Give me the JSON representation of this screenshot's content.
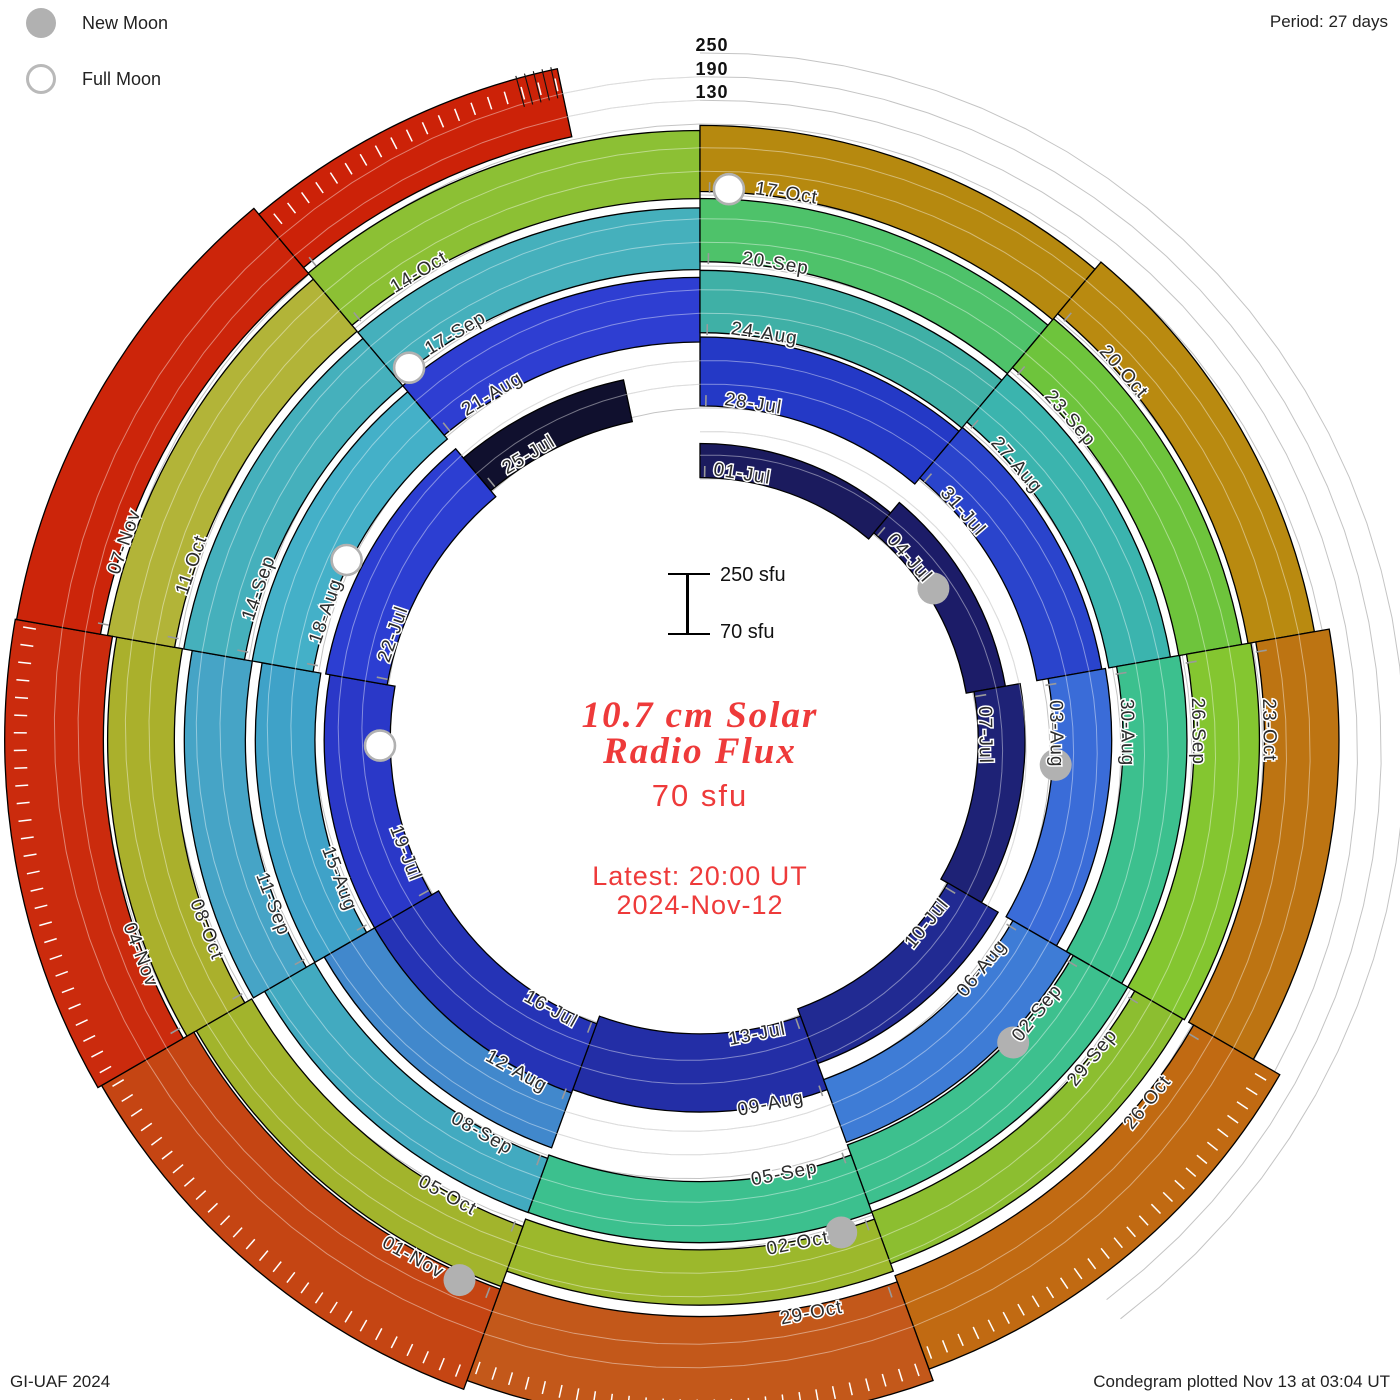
{
  "legend": {
    "new_moon_label": "New Moon",
    "full_moon_label": "Full Moon"
  },
  "header": {
    "period_note": "Period: 27 days"
  },
  "footer": {
    "credit": "GI-UAF 2024",
    "plotted_note": "Condegram plotted Nov 13 at 03:04 UT"
  },
  "radial_scale": {
    "labels": [
      "250",
      "190",
      "130"
    ]
  },
  "center": {
    "scale_top": "250 sfu",
    "scale_bottom": "70 sfu",
    "title_line1": "10.7 cm Solar",
    "title_line2": "Radio Flux",
    "current_value": "70 sfu",
    "latest_line1": "Latest: 20:00 UT",
    "latest_line2": "2024-Nov-12",
    "accent_color": "#ee3a3a"
  },
  "chart_data": {
    "type": "spiral_condegram",
    "title": "10.7 cm Solar Radio Flux",
    "period_days": 27,
    "date_start": "2024-Jul-01",
    "date_end": "2024-Nov-12",
    "flux_scale_sfu": {
      "min": 70,
      "max": 250,
      "ring_gridlines": [
        130,
        190,
        250
      ]
    },
    "grid_color": "#c4c4c4",
    "label_color": "#2b2b2b",
    "moon_color": "#b1b1b1",
    "segments": [
      {
        "date": "01-Jul",
        "ring": 0,
        "a0": 0,
        "a1": 40,
        "color": "#1b1b5e",
        "f0": 0.02,
        "f1": 0.5,
        "sfu": 120
      },
      {
        "date": "04-Jul",
        "ring": 0,
        "a0": 40,
        "a1": 80,
        "color": "#1c1c68",
        "f0": 0.02,
        "f1": 0.58,
        "sfu": 130
      },
      {
        "date": "07-Jul",
        "ring": 0,
        "a0": 80,
        "a1": 120,
        "color": "#1e2276",
        "f0": 0.02,
        "f1": 0.68,
        "sfu": 140
      },
      {
        "date": "10-Jul",
        "ring": 0,
        "a0": 120,
        "a1": 160,
        "color": "#212a92",
        "f0": 0.02,
        "f1": 0.84,
        "sfu": 155
      },
      {
        "date": "13-Jul",
        "ring": 0,
        "a0": 160,
        "a1": 200,
        "color": "#232ea6",
        "f0": 0.02,
        "f1": 1.12,
        "sfu": 215
      },
      {
        "date": "16-Jul",
        "ring": 0,
        "a0": 200,
        "a1": 240,
        "color": "#2533b6",
        "f0": 0.02,
        "f1": 1.06,
        "sfu": 205
      },
      {
        "date": "19-Jul",
        "ring": 0,
        "a0": 240,
        "a1": 280,
        "color": "#2a38c8",
        "f0": 0.02,
        "f1": 0.95,
        "sfu": 190
      },
      {
        "date": "22-Jul",
        "ring": 0,
        "a0": 280,
        "a1": 320,
        "color": "#2c3ed2",
        "f0": 0.02,
        "f1": 0.9,
        "sfu": 185
      },
      {
        "date": "25-Jul",
        "ring": 0,
        "a0": 320,
        "a1": 348,
        "color": "#10102e",
        "f0": 0.02,
        "f1": 0.62,
        "sfu": 135
      },
      {
        "date": "28-Jul",
        "ring": 1,
        "a0": 0,
        "a1": 40,
        "color": "#2439c6",
        "f0": 0.03,
        "f1": 1.0,
        "sfu": 190
      },
      {
        "date": "31-Jul",
        "ring": 1,
        "a0": 40,
        "a1": 80,
        "color": "#2a44cc",
        "f0": 0.03,
        "f1": 0.96,
        "sfu": 186
      },
      {
        "date": "03-Aug",
        "ring": 1,
        "a0": 80,
        "a1": 120,
        "color": "#3a6cd8",
        "f0": 0.08,
        "f1": 0.9,
        "sfu": 178
      },
      {
        "date": "06-Aug",
        "ring": 1,
        "a0": 120,
        "a1": 160,
        "color": "#3e7cd6",
        "f0": 0.08,
        "f1": 1.02,
        "sfu": 182
      },
      {
        "date": "09-Aug",
        "ring": 1,
        "a0": 160,
        "a1": 200,
        "color": null,
        "f0": 0,
        "f1": 0,
        "sfu": null
      },
      {
        "date": "12-Aug",
        "ring": 1,
        "a0": 200,
        "a1": 240,
        "color": "#4188cc",
        "f0": 0.06,
        "f1": 0.88,
        "sfu": 175
      },
      {
        "date": "15-Aug",
        "ring": 1,
        "a0": 240,
        "a1": 280,
        "color": "#3fa2c8",
        "f0": 0.08,
        "f1": 0.92,
        "sfu": 186
      },
      {
        "date": "18-Aug",
        "ring": 1,
        "a0": 280,
        "a1": 320,
        "color": "#44b0c8",
        "f0": 0.08,
        "f1": 0.95,
        "sfu": 195
      },
      {
        "date": "21-Aug",
        "ring": 1,
        "a0": 320,
        "a1": 360,
        "color": "#2e3ed2",
        "f0": 0.04,
        "f1": 0.95,
        "sfu": 185
      },
      {
        "date": "24-Aug",
        "ring": 2,
        "a0": 0,
        "a1": 40,
        "color": "#3fb0a6",
        "f0": 0.06,
        "f1": 0.94,
        "sfu": 196
      },
      {
        "date": "27-Aug",
        "ring": 2,
        "a0": 40,
        "a1": 80,
        "color": "#3bb4ae",
        "f0": 0.06,
        "f1": 0.94,
        "sfu": 196
      },
      {
        "date": "30-Aug",
        "ring": 2,
        "a0": 80,
        "a1": 120,
        "color": "#3cc08e",
        "f0": 0.06,
        "f1": 0.96,
        "sfu": 200
      },
      {
        "date": "02-Sep",
        "ring": 2,
        "a0": 120,
        "a1": 160,
        "color": "#3dc08e",
        "f0": 0.06,
        "f1": 0.95,
        "sfu": 200
      },
      {
        "date": "05-Sep",
        "ring": 2,
        "a0": 160,
        "a1": 200,
        "color": "#3cc08e",
        "f0": 0.1,
        "f1": 0.96,
        "sfu": 200
      },
      {
        "date": "08-Sep",
        "ring": 2,
        "a0": 200,
        "a1": 240,
        "color": "#42aac0",
        "f0": 0.04,
        "f1": 0.85,
        "sfu": 188
      },
      {
        "date": "11-Sep",
        "ring": 2,
        "a0": 240,
        "a1": 280,
        "color": "#46a4c6",
        "f0": 0.06,
        "f1": 0.92,
        "sfu": 192
      },
      {
        "date": "14-Sep",
        "ring": 2,
        "a0": 280,
        "a1": 320,
        "color": "#45b0bc",
        "f0": 0.06,
        "f1": 0.93,
        "sfu": 195
      },
      {
        "date": "17-Sep",
        "ring": 2,
        "a0": 320,
        "a1": 360,
        "color": "#45b0bc",
        "f0": 0.06,
        "f1": 0.93,
        "sfu": 195
      },
      {
        "date": "20-Sep",
        "ring": 3,
        "a0": 0,
        "a1": 40,
        "color": "#4ec26a",
        "f0": 0.06,
        "f1": 0.95,
        "sfu": 205
      },
      {
        "date": "23-Sep",
        "ring": 3,
        "a0": 40,
        "a1": 80,
        "color": "#6ec43c",
        "f0": 0.06,
        "f1": 0.96,
        "sfu": 208
      },
      {
        "date": "26-Sep",
        "ring": 3,
        "a0": 80,
        "a1": 120,
        "color": "#84c630",
        "f0": 0.06,
        "f1": 0.98,
        "sfu": 210
      },
      {
        "date": "29-Sep",
        "ring": 3,
        "a0": 120,
        "a1": 160,
        "color": "#8cbe30",
        "f0": 0.06,
        "f1": 0.84,
        "sfu": 195
      },
      {
        "date": "02-Oct",
        "ring": 3,
        "a0": 160,
        "a1": 200,
        "color": "#9cb82c",
        "f0": 0.06,
        "f1": 0.84,
        "sfu": 195
      },
      {
        "date": "05-Oct",
        "ring": 3,
        "a0": 200,
        "a1": 240,
        "color": "#a2b42c",
        "f0": 0.06,
        "f1": 0.96,
        "sfu": 208
      },
      {
        "date": "08-Oct",
        "ring": 3,
        "a0": 240,
        "a1": 280,
        "color": "#aab02c",
        "f0": 0.06,
        "f1": 1.0,
        "sfu": 215
      },
      {
        "date": "11-Oct",
        "ring": 3,
        "a0": 280,
        "a1": 320,
        "color": "#b2b438",
        "f0": 0.06,
        "f1": 1.02,
        "sfu": 218
      },
      {
        "date": "14-Oct",
        "ring": 3,
        "a0": 320,
        "a1": 360,
        "color": "#8cc034",
        "f0": 0.06,
        "f1": 1.02,
        "sfu": 218
      },
      {
        "date": "17-Oct",
        "ring": 4,
        "a0": 0,
        "a1": 40,
        "color": "#b6890f",
        "f0": 0.05,
        "f1": 0.98,
        "sfu": 232
      },
      {
        "date": "20-Oct",
        "ring": 4,
        "a0": 40,
        "a1": 80,
        "color": "#b98a10",
        "f0": 0.05,
        "f1": 1.0,
        "sfu": 235
      },
      {
        "date": "23-Oct",
        "ring": 4,
        "a0": 80,
        "a1": 120,
        "color": "#bd7412",
        "f0": 0.05,
        "f1": 1.1,
        "sfu": 248
      },
      {
        "date": "26-Oct",
        "ring": 4,
        "a0": 120,
        "a1": 160,
        "color": "#c16a12",
        "f0": 0.02,
        "f1": 1.42,
        "sfu": 300,
        "ticks": "white"
      },
      {
        "date": "29-Oct",
        "ring": 4,
        "a0": 160,
        "a1": 200,
        "color": "#c3581a",
        "f0": 0.0,
        "f1": 1.48,
        "sfu": 305,
        "ticks": "white"
      },
      {
        "date": "01-Nov",
        "ring": 4,
        "a0": 200,
        "a1": 240,
        "color": "#c54513",
        "f0": 0.0,
        "f1": 1.5,
        "sfu": 310,
        "ticks": "white"
      },
      {
        "date": "04-Nov",
        "ring": 4,
        "a0": 240,
        "a1": 280,
        "color": "#cb2b0d",
        "f0": 0.06,
        "f1": 1.45,
        "sfu": 300,
        "ticks": "white"
      },
      {
        "date": "07-Nov",
        "ring": 4,
        "a0": 280,
        "a1": 320,
        "color": "#cc250a",
        "f0": 0.12,
        "f1": 1.32,
        "sfu": 290
      },
      {
        "date": "10-Nov",
        "ring": 4,
        "a0": 320,
        "a1": 348,
        "color": "#cc2208",
        "f0": 0.12,
        "f1": 1.1,
        "sfu": 272,
        "ticks": "white",
        "end_ticks": true,
        "label": false
      }
    ],
    "moons": {
      "new": [
        {
          "date": "2024-Jul-05",
          "ring": 0,
          "angle": 57
        },
        {
          "date": "2024-Aug-04",
          "ring": 1,
          "angle": 94
        },
        {
          "date": "2024-Sep-03",
          "ring": 2,
          "angle": 134
        },
        {
          "date": "2024-Oct-02",
          "ring": 3,
          "angle": 164
        },
        {
          "date": "2024-Nov-01",
          "ring": 4,
          "angle": 204
        }
      ],
      "full": [
        {
          "date": "2024-Jul-21",
          "ring": 0,
          "angle": 269
        },
        {
          "date": "2024-Aug-19",
          "ring": 1,
          "angle": 297
        },
        {
          "date": "2024-Sep-17",
          "ring": 2,
          "angle": 322
        },
        {
          "date": "2024-Oct-17",
          "ring": 4,
          "angle": 3
        }
      ]
    }
  }
}
